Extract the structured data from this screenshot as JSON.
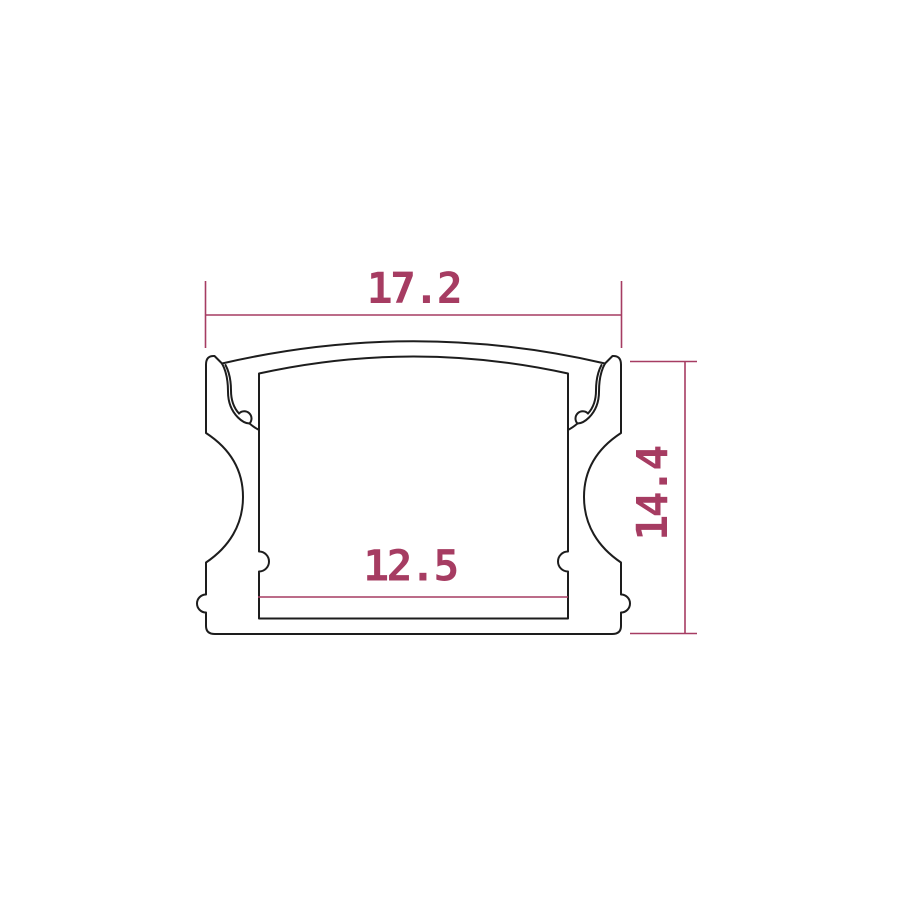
{
  "drawing": {
    "dimensions": {
      "outer_width": {
        "value": "17.2"
      },
      "outer_height": {
        "value": "14.4"
      },
      "inner_width": {
        "value": "12.5"
      }
    },
    "colors": {
      "dimension": "#a63c62",
      "outline": "#1d1d1d",
      "background": "#ffffff"
    }
  }
}
